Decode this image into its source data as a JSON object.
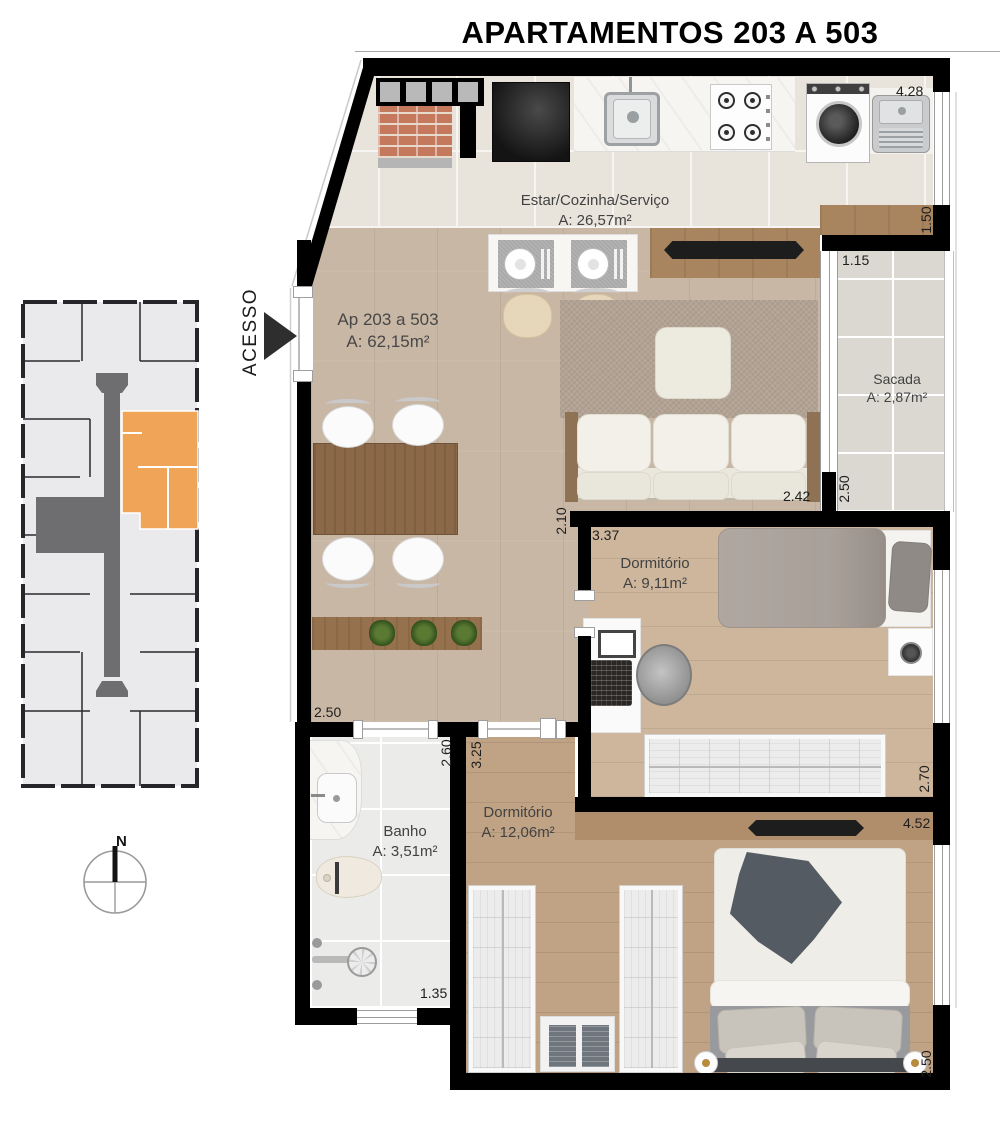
{
  "title": "APARTAMENTOS 203 A 503",
  "access": {
    "label": "ACESSO"
  },
  "compass": {
    "north_label": "N"
  },
  "unit": {
    "name": "Ap 203 a 503",
    "area": "A: 62,15m²"
  },
  "rooms": {
    "kitchen": {
      "name": "Estar/Cozinha/Serviço",
      "area": "A: 26,57m²"
    },
    "sacada": {
      "name": "Sacada",
      "area": "A: 2,87m²"
    },
    "dorm1": {
      "name": "Dormitório",
      "area": "A: 9,11m²"
    },
    "banho": {
      "name": "Banho",
      "area": "A: 3,51m²"
    },
    "dorm2": {
      "name": "Dormitório",
      "area": "A: 12,06m²"
    }
  },
  "dims": {
    "kitchen_top": "4.28",
    "service_side": "1.50",
    "sacada_top": "1.15",
    "sacada_side": "2.50",
    "living_right": "2.42",
    "dorm1_side": "2.10",
    "dorm1_top": "3.37",
    "dorm1_right": "2.70",
    "living_bottom": "2.50",
    "banho_side": "2.60",
    "dorm2_side_top": "3.25",
    "banho_bottom": "1.35",
    "dorm2_top": "4.52",
    "dorm2_right": "2.50"
  },
  "colors": {
    "highlight_unit": "#F0A458",
    "walls": "#000000",
    "wood_floor": "#C8B7A4",
    "tile_floor": "#E8E4DC",
    "corridor_gray": "#6E6E70"
  }
}
